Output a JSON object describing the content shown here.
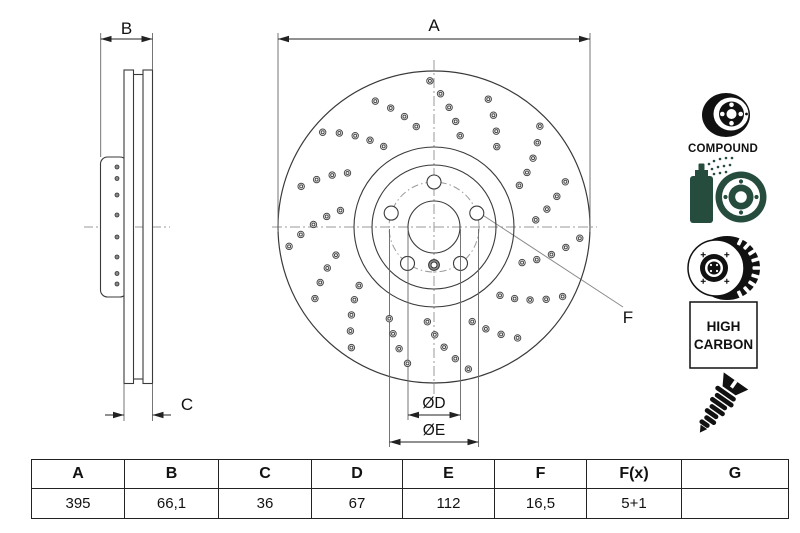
{
  "drawing": {
    "side_view": {
      "label_width": "B",
      "label_thickness": "C"
    },
    "front_view": {
      "label_outer_diameter": "A",
      "label_center_bore": "ØD",
      "label_bolt_circle": "ØE",
      "label_bolt_hole": "F"
    }
  },
  "icons": {
    "compound_label": "COMPOUND",
    "high_carbon_line1": "HIGH",
    "high_carbon_line2": "CARBON",
    "names": [
      "compound-disc-icon",
      "coating-spray-disc-icon",
      "vented-disc-icon",
      "high-carbon-badge",
      "countersunk-screw-icon"
    ]
  },
  "colors": {
    "icon_green": "#254c3d",
    "line_dark": "#3a3a3a",
    "centerline_gray": "#999999"
  },
  "spec_table": {
    "headers": [
      "A",
      "B",
      "C",
      "D",
      "E",
      "F",
      "F(x)",
      "G"
    ],
    "values": [
      "395",
      "66,1",
      "36",
      "67",
      "112",
      "16,5",
      "5+1",
      ""
    ]
  }
}
